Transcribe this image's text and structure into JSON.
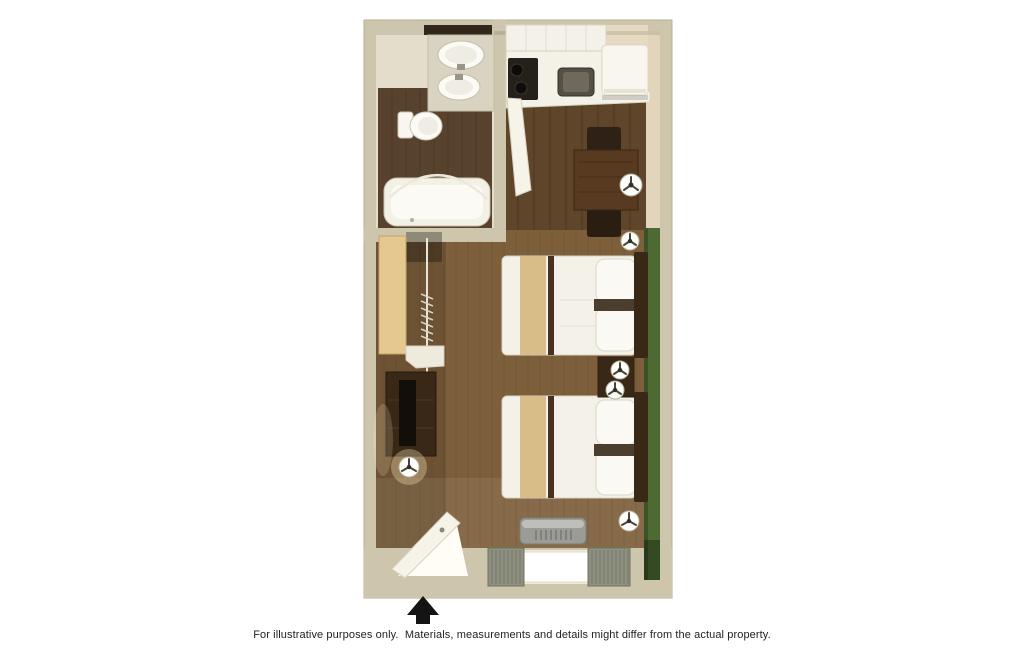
{
  "caption": {
    "text": "For illustrative purposes only.  Materials, measurements and details might differ from the actual property."
  },
  "plan": {
    "type": "studio-suite-3d-floor-plan",
    "entrance_marker": "up-arrow",
    "rooms": [
      {
        "name": "bathroom",
        "fixtures": [
          "mirror",
          "vanity-with-two-sinks",
          "toilet",
          "bathtub",
          "curved-shower-rod"
        ]
      },
      {
        "name": "kitchen",
        "fixtures": [
          "upper-cabinets",
          "countertop",
          "cooktop-two-burners",
          "kitchen-sink",
          "refrigerator",
          "open-door"
        ]
      },
      {
        "name": "dining-nook",
        "fixtures": [
          "dining-table",
          "dining-chair-top",
          "dining-chair-bottom",
          "table-lamp"
        ]
      },
      {
        "name": "sleeping-living-area",
        "fixtures": [
          "double-bed-1",
          "double-bed-2",
          "nightstand",
          "five-round-lamps",
          "closet-with-rod-and-hangers",
          "dresser-with-tv",
          "green-accent-wall",
          "window-with-curtains",
          "ac-unit",
          "open-entry-door"
        ]
      }
    ]
  },
  "colors": {
    "wall": "#cdc6ac",
    "bathroom_wall": "#e4ddcb",
    "bathroom_floor": "#59422d",
    "kitchen_floor": "#5f4529",
    "carpet": "#7d5f3c",
    "green_accent_wall": "#4d6a33",
    "right_wall_tan": "#e3d5bb",
    "counter_white": "#f4f1e8",
    "appliance_white": "#f8f6ef",
    "stove_black": "#24201a",
    "sink_gray": "#555044",
    "table_wood": "#573a20",
    "dark_wood": "#3a2817",
    "tv_black": "#120e09",
    "bed_linen": "#f4f1e9",
    "bed_accent": "#d9bd89",
    "pillow_white": "#fbf9f3",
    "closet_door_tan": "#e4c88f",
    "window_white": "#ffffff",
    "curtain_gray": "#8e9080",
    "ac_gray": "#9c9c96",
    "door_white": "#f6f3e9",
    "lamp_white": "#fdfdf9",
    "arrow_black": "#141414"
  }
}
